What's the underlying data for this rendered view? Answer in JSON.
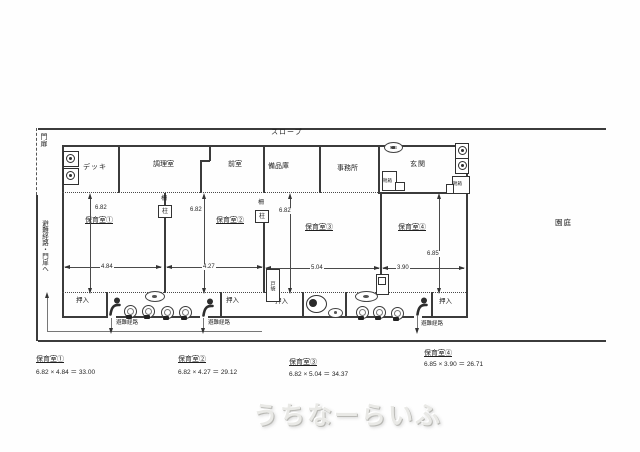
{
  "site": {
    "slope": "スロープ",
    "gate": "門扉",
    "evac_to_gate": "避難経路・門扉へ",
    "garden": "園庭"
  },
  "upper_rooms": {
    "deck": "デッキ",
    "kitchen": "調理室",
    "anteroom": "前室",
    "storage": "備品庫",
    "office": "事務所",
    "entrance": "玄関"
  },
  "labels": {
    "closet": "押入",
    "evac_route": "避難経路",
    "shoe_box": "靴箱",
    "pillar": "柱",
    "fence": "柵",
    "door_pocket": "戸袋",
    "meter_box": "MB"
  },
  "rooms": [
    {
      "name": "保育室①",
      "w": "4.84",
      "h": "6.82"
    },
    {
      "name": "保育室②",
      "w": "4.27",
      "h": "6.82"
    },
    {
      "name": "保育室③",
      "w": "5.04",
      "h": "6.82"
    },
    {
      "name": "保育室④",
      "w": "3.90",
      "h": "6.85"
    }
  ],
  "summary": [
    {
      "title": "保育室①",
      "formula": "6.82 × 4.84 ＝ 33.00"
    },
    {
      "title": "保育室②",
      "formula": "6.82 × 4.27 ＝ 29.12"
    },
    {
      "title": "保育室③",
      "formula": "6.82 × 5.04 ＝ 34.37"
    },
    {
      "title": "保育室④",
      "formula": "6.85 × 3.90 ＝ 26.71"
    }
  ],
  "watermark": "うちなーらいふ"
}
